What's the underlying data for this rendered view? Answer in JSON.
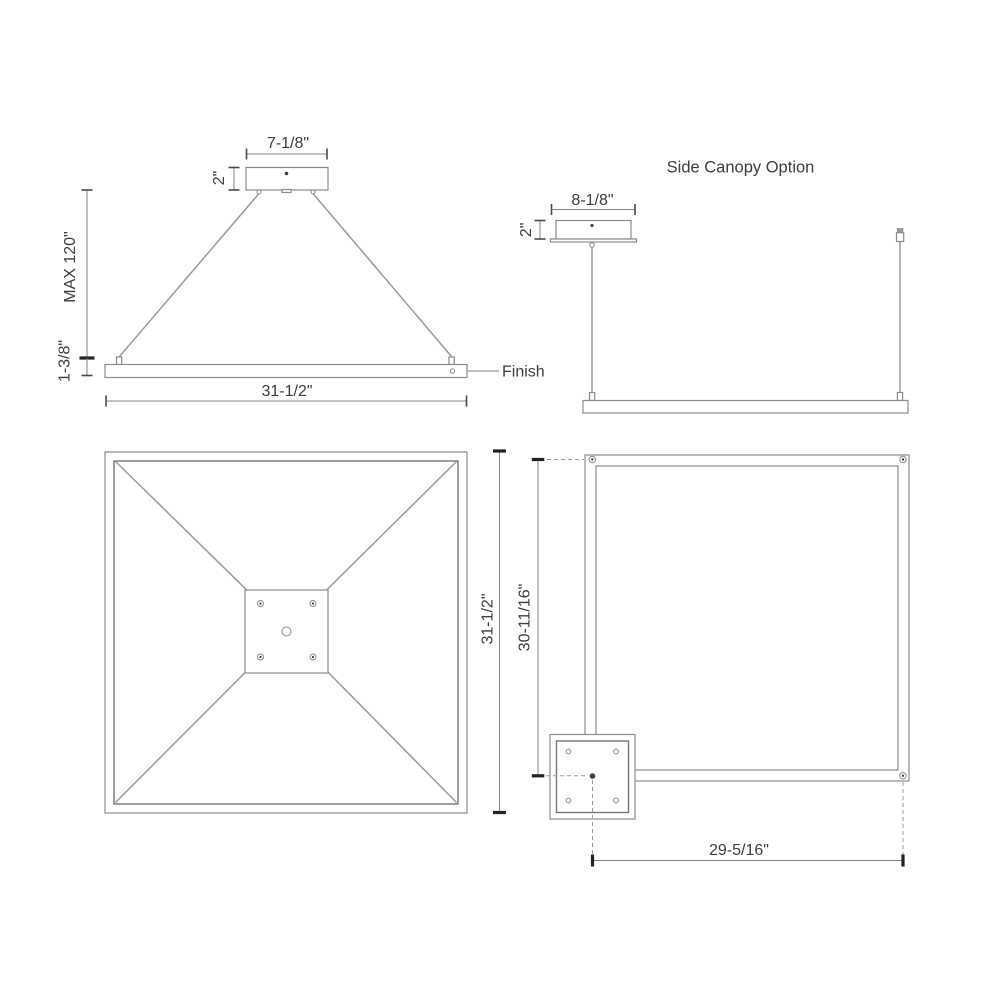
{
  "front_view": {
    "canopy_width": "7-1/8\"",
    "canopy_height": "2\"",
    "max_suspension": "MAX 120\"",
    "fixture_height": "1-3/8\"",
    "fixture_width": "31-1/2\"",
    "finish_label": "Finish"
  },
  "side_view": {
    "title": "Side Canopy Option",
    "canopy_width": "8-1/8\"",
    "canopy_height": "2\""
  },
  "plan_view": {
    "fixture_depth": "31-1/2\""
  },
  "side_plan_view": {
    "vertical_dim": "30-11/16\"",
    "horizontal_dim": "29-5/16\""
  },
  "colors": {
    "line": "#8a8a8a",
    "dimension": "#828282",
    "text": "#3d3d3d",
    "background": "#ffffff"
  }
}
